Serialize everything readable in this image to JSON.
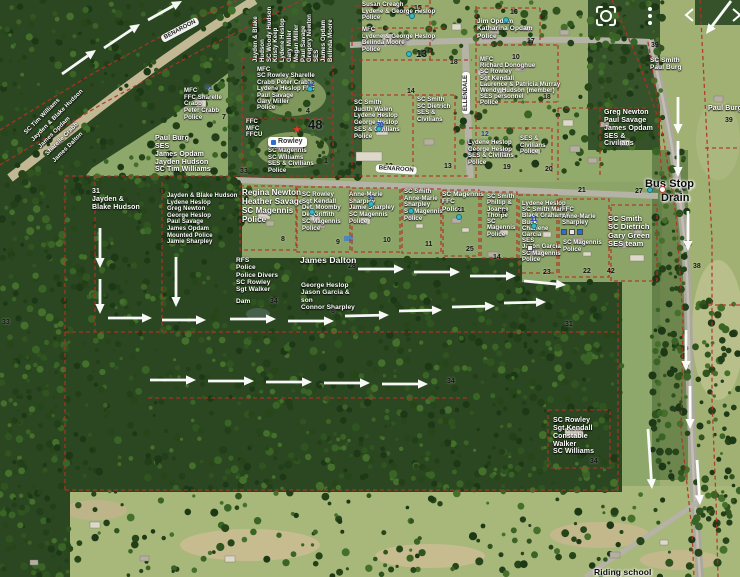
{
  "ui": {
    "icons": [
      {
        "name": "screenshot-lens-icon"
      },
      {
        "name": "more-options-icon"
      },
      {
        "name": "bracket-left-icon"
      },
      {
        "name": "bracket-right-icon"
      }
    ]
  },
  "map": {
    "road_labels": [
      {
        "text": "BENAROON",
        "x": 160,
        "y": 36,
        "rot": -28
      },
      {
        "text": "BENAROON",
        "x": 376,
        "y": 164,
        "rot": 4
      },
      {
        "text": "ELLENDALE",
        "x": 462,
        "y": 114,
        "rot": -90
      }
    ],
    "chip": {
      "text": "Rowley",
      "x": 268,
      "y": 137
    },
    "labels": [
      {
        "x": 22,
        "y": 130,
        "rot": -45,
        "fs": 6,
        "lh": 10,
        "lines": [
          "SC Tim Williams",
          "Jayden & Blake Hudson",
          "James Opdam",
          "Sharelle Crabb",
          "James Dalton"
        ]
      },
      {
        "x": 253,
        "y": 62,
        "rot": -90,
        "fs": 6,
        "lh": 6.8,
        "lines": [
          "Jayden & Blake",
          "Hudson",
          "SC Woody Hudson",
          "Kristy Keep",
          "Lydene Heslop",
          "Gary Miller",
          "Megan Miller",
          "Paul Savage",
          "Gregory Newton",
          "SES",
          "James Opdam",
          "Belinda Moore"
        ]
      },
      {
        "x": 362,
        "y": 2,
        "fs": 6,
        "lines": [
          "Susan Creagh",
          "Lydene & George Heslop",
          "Police"
        ]
      },
      {
        "x": 362,
        "y": 27,
        "fs": 6,
        "lines": [
          "MFC",
          "Lydene & George Heslop",
          "Belinda Moore",
          "Police"
        ]
      },
      {
        "x": 477,
        "y": 18,
        "fs": 6.5,
        "lines": [
          "Jim Opdam",
          "Katharina Opdam",
          "Police"
        ]
      },
      {
        "x": 480,
        "y": 57,
        "fs": 6,
        "lh": 6.2,
        "lines": [
          "MFC",
          "Richard Donoghue",
          "SC Rowley",
          "Sgt Kendall",
          "Laurence & Patricia Murray",
          "Wendy Hudson (member)",
          "SES personnel",
          "Police"
        ]
      },
      {
        "x": 354,
        "y": 100,
        "fs": 6,
        "lines": [
          "SC Smith",
          "Judith Walen",
          "Lydene Heslop",
          "George Heslop",
          "SES & Civilians",
          "Police"
        ]
      },
      {
        "x": 417,
        "y": 97,
        "fs": 6,
        "lines": [
          "SC Smith",
          "SC Dietrich",
          "SES &",
          "Civilians"
        ]
      },
      {
        "x": 257,
        "y": 67,
        "fs": 6,
        "lh": 6.4,
        "lines": [
          "MFC",
          "SC Rowley Sharelle",
          "Crabb Peter Crabb",
          "Lydene Heslop FFC",
          "Paul Savage",
          "Gary Miller",
          "Police"
        ]
      },
      {
        "x": 246,
        "y": 119,
        "fs": 6,
        "lines": [
          "FFC",
          "MFC",
          "FFCU"
        ]
      },
      {
        "x": 268,
        "y": 148,
        "fs": 6,
        "lines": [
          "SC Magennis",
          "SC Williams",
          "SES & Civilians",
          "Police"
        ]
      },
      {
        "x": 155,
        "y": 135,
        "fs": 7,
        "lines": [
          "Paul Burg",
          "SES",
          "James Opdam",
          "Jayden Hudson",
          "SC Tim Williams"
        ]
      },
      {
        "x": 184,
        "y": 88,
        "fs": 6,
        "lines": [
          "MFC",
          "FFC Sharelle",
          "Crabb",
          "Peter Crabb",
          "Police"
        ]
      },
      {
        "x": 92,
        "y": 188,
        "fs": 7,
        "lines": [
          "31",
          "Jayden &",
          "Blake Hudson"
        ]
      },
      {
        "x": 167,
        "y": 193,
        "fs": 6,
        "lh": 6.6,
        "lines": [
          "Jayden & Blake Hudson",
          "Lydene Heslop",
          "Greg Newton",
          "George Heslop",
          "Paul Savage",
          "James Opdam",
          "Mounted Police",
          "Jamie Sharpley"
        ]
      },
      {
        "x": 242,
        "y": 189,
        "fs": 8,
        "lines": [
          "Regina Newton",
          "Heather Savage",
          "SC Magennis",
          "Police"
        ]
      },
      {
        "x": 302,
        "y": 192,
        "fs": 6,
        "lines": [
          "SC Rowley",
          "Sgt Kendall",
          "Det. Moomby",
          "Det Griffith",
          "SC Magennis",
          "Police"
        ]
      },
      {
        "x": 349,
        "y": 192,
        "fs": 6,
        "lines": [
          "Anne-Marie",
          "Sharpley",
          "Jamie Sharpley",
          "SC Magennis",
          "Police"
        ]
      },
      {
        "x": 404,
        "y": 189,
        "fs": 6,
        "lines": [
          "SC Smith",
          "Anne-Marie",
          "Sharpley",
          "SC Magennis",
          "Police"
        ]
      },
      {
        "x": 442,
        "y": 191,
        "fs": 6.5,
        "lines": [
          "SC Magennis",
          "FFC",
          "Police"
        ]
      },
      {
        "x": 487,
        "y": 194,
        "fs": 6,
        "lh": 6.3,
        "lines": [
          "SC Smith",
          "Phillip &",
          "Joanne",
          "Thorpe",
          "SC",
          "Magennis",
          "Police"
        ]
      },
      {
        "x": 522,
        "y": 201,
        "fs": 6,
        "lh": 6.2,
        "lines": [
          "Lydene Heslop",
          "SC Smith Mark",
          "Black Graham &",
          "Buck",
          "Charlene",
          "Garcia",
          "SES",
          "Jason Garcia",
          "SC Magennis",
          "Police"
        ]
      },
      {
        "x": 562,
        "y": 207,
        "fs": 6,
        "lines": [
          "FFC",
          "Anne-Marie",
          "Sharpley"
        ]
      },
      {
        "x": 563,
        "y": 240,
        "fs": 6,
        "lines": [
          "SC Magennis",
          "Police"
        ]
      },
      {
        "x": 608,
        "y": 215,
        "fs": 7.5,
        "lines": [
          "SC Smith",
          "SC Dietrich",
          "Gary Green",
          "SES team"
        ]
      },
      {
        "x": 604,
        "y": 109,
        "fs": 7,
        "lines": [
          "Greg Newton",
          "Paul Savage",
          "James Opdam",
          "SES &",
          "Civilians"
        ]
      },
      {
        "x": 650,
        "y": 57,
        "fs": 6.5,
        "lines": [
          "SC Smith",
          "Paul Burg"
        ]
      },
      {
        "x": 708,
        "y": 105,
        "fs": 7,
        "lines": [
          "Paul Burg"
        ]
      },
      {
        "x": 468,
        "y": 140,
        "fs": 6,
        "lines": [
          "Lydene Heslop",
          "George Heslop",
          "SES & Civilians",
          "Police"
        ]
      },
      {
        "x": 520,
        "y": 136,
        "fs": 6,
        "lines": [
          "SES &",
          "Civilians",
          "Police"
        ]
      },
      {
        "x": 236,
        "y": 257,
        "fs": 6.5,
        "lines": [
          "RFS",
          "Police",
          "Police Divers",
          "SC Rowley",
          "Sgt Walker"
        ]
      },
      {
        "x": 236,
        "y": 298,
        "fs": 6.5,
        "lines": [
          "Dam"
        ]
      },
      {
        "x": 300,
        "y": 256,
        "fs": 8.5,
        "lines": [
          "James Dalton"
        ]
      },
      {
        "x": 301,
        "y": 282,
        "fs": 6.5,
        "lines": [
          "George Heslop",
          "Jason Garcia &",
          "son",
          "Connor Sharpley"
        ]
      },
      {
        "x": 553,
        "y": 417,
        "fs": 7,
        "lines": [
          "SC Rowley",
          "Sgt Kendall",
          "Constable",
          "Walker",
          "SC Williams"
        ]
      },
      {
        "x": 645,
        "y": 178,
        "fs": 11,
        "style": "dark",
        "lines": [
          "Bus Stop"
        ]
      },
      {
        "x": 661,
        "y": 192,
        "fs": 11,
        "style": "dark",
        "lines": [
          "Drain"
        ]
      },
      {
        "x": 594,
        "y": 568,
        "fs": 8.5,
        "style": "dark",
        "lines": [
          "Riding school"
        ]
      }
    ],
    "numbers": [
      [
        "7",
        222,
        114
      ],
      [
        "51",
        205,
        85,
        "b"
      ],
      [
        "52",
        307,
        81,
        "b"
      ],
      [
        "4",
        306,
        108
      ],
      [
        "48",
        308,
        117,
        "k",
        13
      ],
      [
        "1",
        324,
        158
      ],
      [
        "33",
        240,
        168
      ],
      [
        "30",
        376,
        122,
        "b"
      ],
      [
        "12",
        385,
        163
      ],
      [
        "13",
        444,
        163
      ],
      [
        "14",
        407,
        88
      ],
      [
        "13",
        416,
        49,
        "k",
        10
      ],
      [
        "18",
        450,
        59
      ],
      [
        "15",
        414,
        5
      ],
      [
        "16",
        510,
        9
      ],
      [
        "17",
        527,
        38
      ],
      [
        "10",
        512,
        54
      ],
      [
        "18",
        543,
        94
      ],
      [
        "12",
        481,
        131,
        "b"
      ],
      [
        "19",
        503,
        164
      ],
      [
        "20",
        545,
        166
      ],
      [
        "21",
        578,
        187
      ],
      [
        "8",
        281,
        236
      ],
      [
        "9",
        336,
        239
      ],
      [
        "31",
        367,
        195,
        "b"
      ],
      [
        "10",
        383,
        237
      ],
      [
        "11",
        425,
        241
      ],
      [
        "21",
        457,
        207
      ],
      [
        "25",
        466,
        246
      ],
      [
        "19",
        499,
        209
      ],
      [
        "14",
        493,
        254
      ],
      [
        "11",
        530,
        216,
        "b"
      ],
      [
        "23",
        543,
        269
      ],
      [
        "22",
        583,
        268
      ],
      [
        "42",
        607,
        268
      ],
      [
        "27",
        635,
        188
      ],
      [
        "39",
        651,
        42
      ],
      [
        "39",
        725,
        117
      ],
      [
        "38",
        693,
        263
      ],
      [
        "28",
        348,
        263
      ],
      [
        "6",
        331,
        308
      ],
      [
        "31",
        565,
        321
      ],
      [
        "34",
        447,
        378
      ],
      [
        "34",
        590,
        458
      ],
      [
        "34",
        270,
        298
      ],
      [
        "33",
        2,
        319
      ]
    ],
    "markers": {
      "dots": [
        [
          412,
          16
        ],
        [
          506,
          20
        ],
        [
          409,
          54
        ],
        [
          310,
          89
        ],
        [
          379,
          129
        ],
        [
          312,
          212
        ],
        [
          371,
          204
        ],
        [
          411,
          211
        ],
        [
          459,
          217
        ],
        [
          534,
          226
        ],
        [
          650,
          190
        ]
      ],
      "star": [
        297,
        130
      ],
      "circle": [
        662,
        189
      ],
      "squares": [
        [
          561,
          229,
          "#2d6fd0"
        ],
        [
          569,
          229,
          "#e8e8e8"
        ],
        [
          577,
          229,
          "#2d6fd0"
        ],
        [
          527,
          245,
          "#e8e8e8"
        ]
      ]
    },
    "arrows": [
      [
        62,
        74,
        96,
        50
      ],
      [
        104,
        48,
        140,
        24
      ],
      [
        148,
        20,
        182,
        1
      ],
      [
        731,
        1,
        706,
        34
      ],
      [
        678,
        97,
        678,
        134
      ],
      [
        678,
        141,
        678,
        177
      ],
      [
        688,
        211,
        688,
        251
      ],
      [
        686,
        330,
        686,
        371
      ],
      [
        690,
        386,
        690,
        429
      ],
      [
        648,
        429,
        652,
        489
      ],
      [
        697,
        460,
        700,
        505
      ],
      [
        100,
        228,
        100,
        268
      ],
      [
        100,
        279,
        100,
        314
      ],
      [
        176,
        257,
        176,
        307
      ],
      [
        358,
        269,
        404,
        269
      ],
      [
        414,
        272,
        460,
        272
      ],
      [
        470,
        276,
        516,
        276
      ],
      [
        524,
        281,
        566,
        285
      ],
      [
        108,
        318,
        152,
        318
      ],
      [
        162,
        320,
        206,
        320
      ],
      [
        230,
        319,
        276,
        319
      ],
      [
        288,
        321,
        334,
        321
      ],
      [
        345,
        316,
        389,
        315
      ],
      [
        399,
        311,
        442,
        310
      ],
      [
        452,
        307,
        495,
        306
      ],
      [
        504,
        303,
        546,
        302
      ],
      [
        150,
        380,
        196,
        380
      ],
      [
        208,
        381,
        254,
        381
      ],
      [
        266,
        382,
        312,
        382
      ],
      [
        324,
        383,
        370,
        383
      ],
      [
        382,
        384,
        428,
        384
      ]
    ]
  }
}
